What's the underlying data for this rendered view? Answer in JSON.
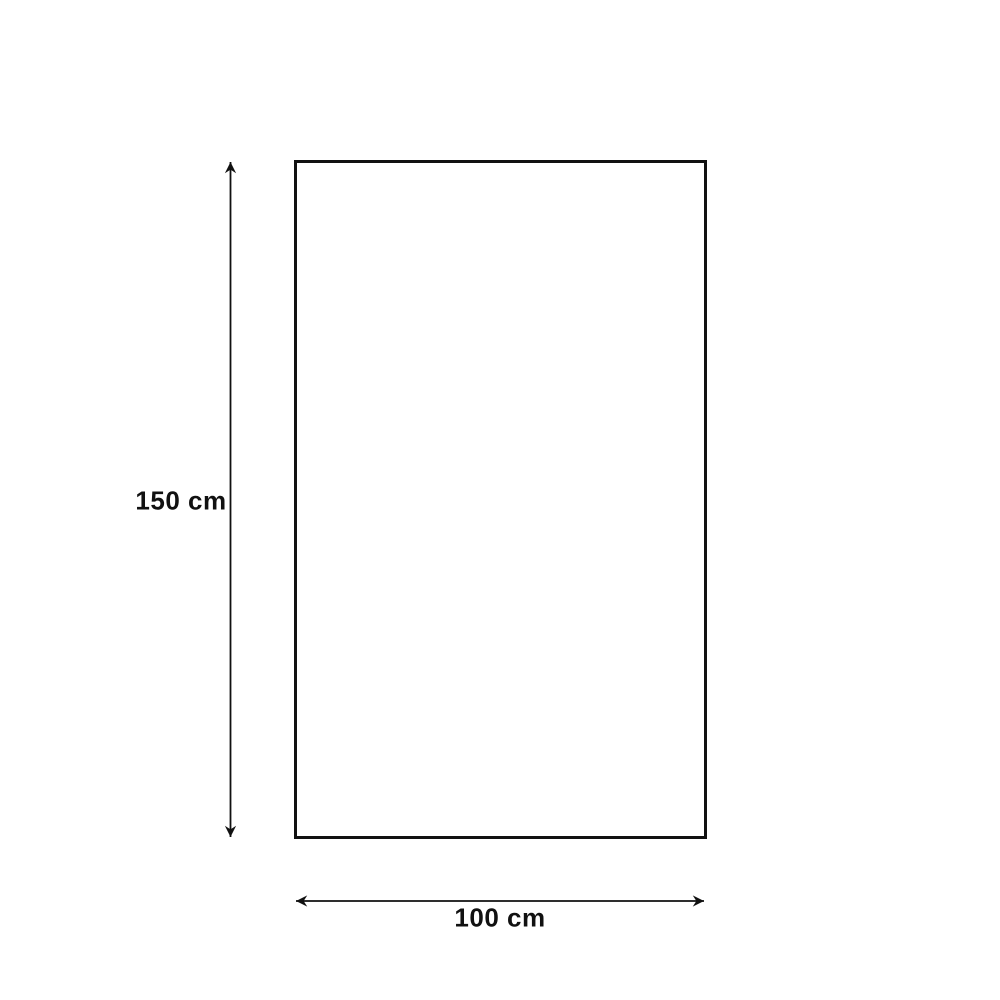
{
  "diagram": {
    "type": "dimension-diagram",
    "shape": "rectangle",
    "height": {
      "value": 150,
      "unit": "cm",
      "label": "150 cm"
    },
    "width": {
      "value": 100,
      "unit": "cm",
      "label": "100 cm"
    },
    "colors": {
      "line": "#111111",
      "text": "#111111",
      "background": "#ffffff"
    }
  }
}
